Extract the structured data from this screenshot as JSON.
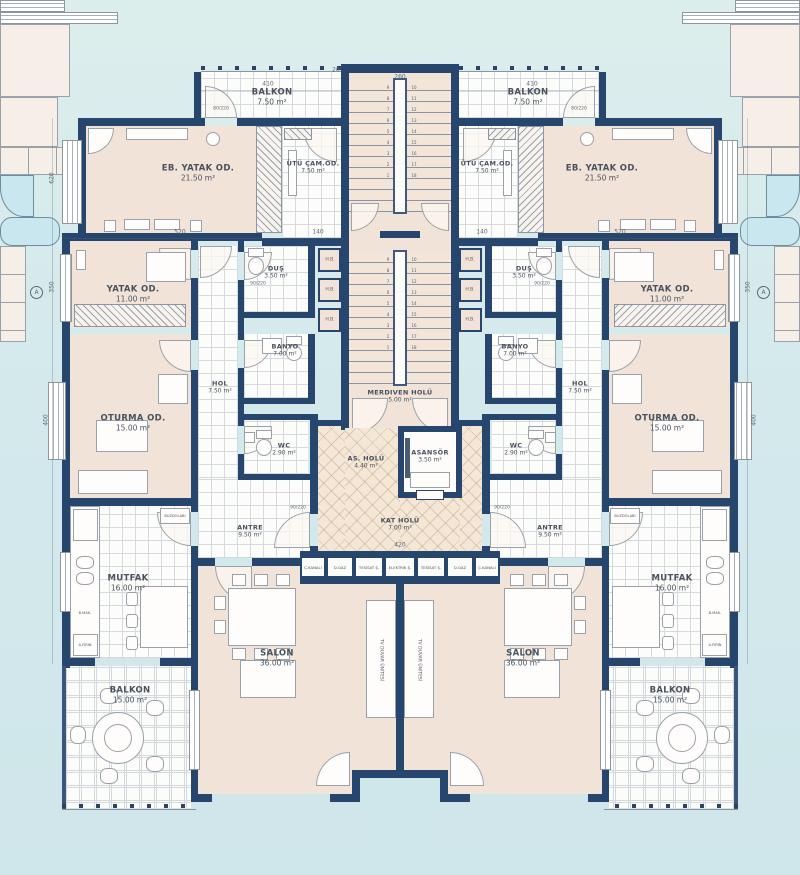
{
  "rooms": {
    "balkon_ust": {
      "name": "BALKON",
      "area": "7.50 m²"
    },
    "eb_yatak": {
      "name": "EB. YATAK OD.",
      "area": "21.50 m²"
    },
    "utu": {
      "name": "ÜTÜ ÇAM.OD.",
      "area": "7.50 m²"
    },
    "yatak": {
      "name": "YATAK OD.",
      "area": "11.00 m²"
    },
    "dus": {
      "name": "DUŞ",
      "area": "3.50 m²"
    },
    "banyo": {
      "name": "BANYO",
      "area": "7.00 m²"
    },
    "hol": {
      "name": "HOL",
      "area": "7.50 m²"
    },
    "oturma": {
      "name": "OTURMA OD.",
      "area": "15.00 m²"
    },
    "wc": {
      "name": "WC",
      "area": "2.90 m²"
    },
    "antre": {
      "name": "ANTRE",
      "area": "9.50 m²"
    },
    "mutfak": {
      "name": "MUTFAK",
      "area": "16.00 m²"
    },
    "salon": {
      "name": "SALON",
      "area": "36.00 m²"
    },
    "balkon_alt": {
      "name": "BALKON",
      "area": "15.00 m²"
    },
    "merdiven_holu": {
      "name": "MERDIVEN HOLÜ",
      "area": "5.00 m²"
    },
    "as_holu": {
      "name": "AS. HOLÜ",
      "area": "4.40 m²"
    },
    "asansor": {
      "name": "ASANSÖR",
      "area": "3.50 m²"
    },
    "kat_holu": {
      "name": "KAT HOLÜ",
      "area": "7.00 m²"
    }
  },
  "shafts": {
    "ckanali": "Ç.KANALI",
    "dgaz": "D.GAZ",
    "tesisat": "TESİSAT Ş.",
    "elektrik": "ELEKTRİK Ş."
  },
  "small_labels": {
    "hb": "H.B.",
    "buzdolabi": "BUZDOLABI",
    "afirin": "A.FIRIN",
    "bmak": "B.MAK.",
    "tv_unit": "TV DUVAR ÜNİTESİ",
    "marker": "A"
  },
  "door_tags": {
    "d90": "90/220",
    "d80": "80/220"
  },
  "dims": {
    "d410": "410",
    "d260": "260",
    "d620": "620",
    "d350": "350",
    "d400": "400",
    "d520": "520",
    "d140": "140",
    "d420": "420",
    "d20": "20"
  },
  "stairs": {
    "flight_down": "9 8 7 6 5 4 3 2 1",
    "flight_up": "10 11 12 13 14 15 16 17 18"
  }
}
